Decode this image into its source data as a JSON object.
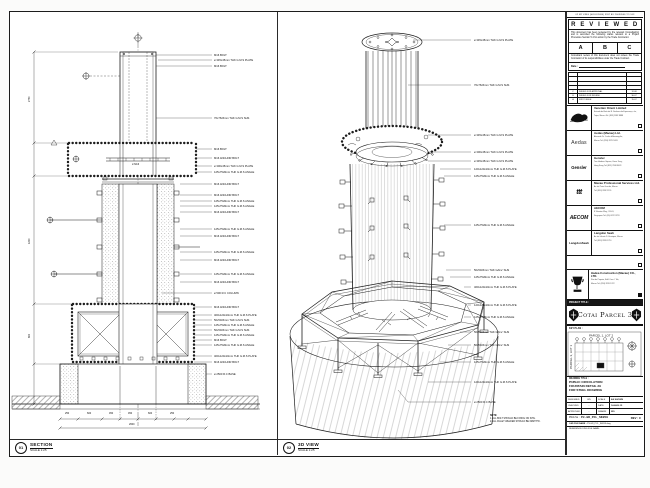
{
  "views": {
    "section": {
      "id": "01",
      "title": "SECTION",
      "scale": "SCALE 1:25",
      "callouts": [
        {
          "y": 43,
          "t": "M16 BOLT"
        },
        {
          "y": 48,
          "t": "ø 345x45mm THK G.M.S PLATE"
        },
        {
          "y": 54,
          "t": "M16 BOLT"
        },
        {
          "y": 106,
          "t": "76x76x5mm THK G.M.S SHS"
        },
        {
          "y": 137,
          "t": "M16 BOLT"
        },
        {
          "y": 146,
          "t": "M16 ANCHOR BOLT"
        },
        {
          "y": 154,
          "t": "ø 300x45mm THK G.M.S PLATE"
        },
        {
          "y": 160,
          "t": "125x75x8mm THK G.M.S ANGLE"
        },
        {
          "y": 172,
          "t": "M16 ANCHOR BOLT"
        },
        {
          "y": 183,
          "t": "M16 ANCHOR BOLT"
        },
        {
          "y": 189,
          "t": "125x75x8mm THK G.M.S ANGLE"
        },
        {
          "y": 194,
          "t": "125x75x8mm THK G.M.S ANGLE"
        },
        {
          "y": 200,
          "t": "M16 ANCHOR BOLT"
        },
        {
          "y": 217,
          "t": "125x75x8mm THK G.M.S ANGLE"
        },
        {
          "y": 224,
          "t": "M16 ANCHOR BOLT"
        },
        {
          "y": 240,
          "t": "125x75x8mm THK G.M.S ANGLE"
        },
        {
          "y": 248,
          "t": "M16 ANCHOR BOLT"
        },
        {
          "y": 262,
          "t": "125x75x8mm THK G.M.S ANGLE"
        },
        {
          "y": 270,
          "t": "M16 ANCHOR BOLT"
        },
        {
          "y": 281,
          "t": "ø 500 R.C COLUMN"
        },
        {
          "y": 295,
          "t": "M16 ANCHOR BOLT"
        },
        {
          "y": 303,
          "t": "400x120x10mm THK G.M.S PLATE"
        },
        {
          "y": 308,
          "t": "50x50x5mm THK G.M.S SHS"
        },
        {
          "y": 313,
          "t": "125x75x8mm THK G.M.S ANGLE"
        },
        {
          "y": 318,
          "t": "50x50x5mm THK G.M.S SHS"
        },
        {
          "y": 323,
          "t": "125x75x8mm THK G.M.S ANGLE"
        },
        {
          "y": 328,
          "t": "M16 BOLT"
        },
        {
          "y": 333,
          "t": "125x75x8mm THK G.M.S ANGLE"
        },
        {
          "y": 344,
          "t": "400x120x10mm THK G.M.S PLATE"
        },
        {
          "y": 350,
          "t": "M16 ANCHOR BOLT"
        },
        {
          "y": 362,
          "t": "ø 2500 R.C BASE"
        }
      ],
      "microtexts": [
        {
          "x": 55,
          "y": 401,
          "t": "250"
        },
        {
          "x": 77,
          "y": 401,
          "t": "600"
        },
        {
          "x": 99,
          "y": 401,
          "t": "450"
        },
        {
          "x": 118,
          "y": 401,
          "t": "450"
        },
        {
          "x": 138,
          "y": 401,
          "t": "600"
        },
        {
          "x": 160,
          "y": 401,
          "t": "250"
        },
        {
          "x": 119,
          "y": 412,
          "t": "2600"
        },
        {
          "x": 19,
          "y": 90,
          "t": "2750",
          "r": -90
        },
        {
          "x": 19,
          "y": 232,
          "t": "1200",
          "r": -90
        },
        {
          "x": 19,
          "y": 326,
          "t": "800",
          "r": -90
        },
        {
          "x": 122,
          "y": 152,
          "t": "2-M16"
        }
      ]
    },
    "iso": {
      "id": "02",
      "title": "3D VIEW",
      "scale": "SCALE 1:25",
      "callouts": [
        {
          "y": 28,
          "t": "ø 345x45mm THK G.M.S PLATE"
        },
        {
          "y": 73,
          "t": "76x76x5mm THK G.M.S SHS"
        },
        {
          "y": 123,
          "t": "ø 345x45mm THK G.M.S PLATE"
        },
        {
          "y": 140,
          "t": "ø 300x45mm THK G.M.S PLATE"
        },
        {
          "y": 149,
          "t": "ø 345x45mm THK G.M.S PLATE"
        },
        {
          "y": 157,
          "t": "120x120x10mm THK G.M.S PLATE"
        },
        {
          "y": 164,
          "t": "125x75x8mm THK G.M.S ANGLE"
        },
        {
          "y": 213,
          "t": "125x75x8mm THK G.M.S ANGLE"
        },
        {
          "y": 258,
          "t": "50x50x5mm THK GALV. SHS"
        },
        {
          "y": 265,
          "t": "125x75x8mm THK G.M.S ANGLE"
        },
        {
          "y": 275,
          "t": "460x120x10mm THK G.M.S PLATE"
        },
        {
          "y": 293,
          "t": "120x120x10mm THK G.M.S PLATE"
        },
        {
          "y": 305,
          "t": "125x75x8mm THK G.M.S ANGLE"
        },
        {
          "y": 320,
          "t": "50x50x5mm THK GALV. SHS"
        },
        {
          "y": 333,
          "t": "50x50x5mm THK GALV. SHS"
        },
        {
          "y": 350,
          "t": "125x75x8mm THK G.M.S ANGLE"
        },
        {
          "y": 370,
          "t": "120x120x10mm THK G.M.S PLATE"
        },
        {
          "y": 390,
          "t": "ø 2500 R.C BASE"
        }
      ],
      "note_title": "NOTE:",
      "note1": "1. ALL BOLT SHOULD BE FIXING ON SITE.",
      "note2": "2. ALL FILLET WELDED SHOULD BE 6MM THK."
    }
  },
  "titleblock": {
    "fax_header": "02 MY KING (HOLDINGS) 9997 AY 20030506 TO 103",
    "stamp": {
      "title": "R E V I E W E D",
      "para1": "This document has been reviewed by the relevant Consultant(s) and is accorded the following status relevant to a Project Procedure Section 5.4 for action by the Trade Contractor.",
      "options": {
        "a": "A",
        "b": "B",
        "c": "C"
      },
      "para2": "Consultant review of this document does not relieve the Trade Contractor of its responsibilities under the Trade Contract.",
      "date_label": "Date :"
    },
    "revisions": [
      {
        "rev": "",
        "desc": "",
        "date": ""
      },
      {
        "rev": "",
        "desc": "",
        "date": ""
      },
      {
        "rev": "",
        "desc": "",
        "date": ""
      },
      {
        "rev": "",
        "desc": "",
        "date": ""
      },
      {
        "rev": "C",
        "desc": "ISSUED FOR APPROVAL",
        "date": "12-08"
      },
      {
        "rev": "B",
        "desc": "ISSUED FOR REVIEW",
        "date": "30-07"
      },
      {
        "rev": "A",
        "desc": "FIRST ISSUE",
        "date": "15-07"
      }
    ],
    "consultants": [
      {
        "logo": "VOL",
        "name": "Venetian Orient Limited",
        "line1": "Estrada da Baía de N. Senhora da Esperança, s/n,",
        "line2": "Taipa, Macau   Tel: (853) 2882 8888"
      },
      {
        "logo": "Aedas",
        "name": "Aedas (Macau) Ltd.",
        "line1": "Alameda Dr. Carlos d'Assumpção,",
        "line2": "Macau   Tel: (853) 2875 5033"
      },
      {
        "logo": "Gensler",
        "name": "Gensler",
        "line1": "Two Harbour Square, Kwun Tong,",
        "line2": "Hong Kong   Tel: (852) 2598 8023"
      },
      {
        "logo": "ttt",
        "name": "Macau Professional Services Ltd.",
        "line1": "Av. da Praia Grande, Macau",
        "line2": "Tel: (853) 2832 2155"
      },
      {
        "logo": "AECOM",
        "name": "AECOM",
        "line1": "8 Shenton Way, #11-01,",
        "line2": "Singapore   Tel: (65) 6222 3733"
      },
      {
        "logo": "LangdonSeah",
        "name": "Langdon Seah",
        "line1": "Av. do Infante D. Henrique, Macau",
        "line2": "Tel: (853) 2833 1710"
      }
    ],
    "contractor": {
      "name": "Hadea Construction (Macau) CO., LTD.",
      "line1": "Rua de Pequim, Edif. Com. I Tak,",
      "line2": "Macau   Tel: (853) 2870 1222"
    },
    "project_title_label": "PROJECT TITLE :",
    "project_title": "Cotai Parcel 3",
    "key_plan_label": "KEY PLAN :",
    "key_plan": {
      "top_label": "PARCEL 1, LOT 2",
      "side_label": "PARCEL 3, LOT 1"
    },
    "drawing_title_label": "DRAWING TITLE :",
    "drawing_title": {
      "l1": "PUBLIC CIRCULATION",
      "l2": "FOUNTAIN DETAIL 29",
      "l3": "FOR STEEL DRAWING"
    },
    "approvals": [
      {
        "label": "DESIGNED",
        "value": "WS",
        "label2": "SCALE",
        "value2": "AS SHOWN"
      },
      {
        "label": "CHECKED",
        "value": "-",
        "label2": "DATE",
        "value2": "14-AUG-15"
      },
      {
        "label": "APPROVED",
        "value": "-",
        "label2": "DRAWN",
        "value2": "WS"
      }
    ],
    "dwg_no_label": "DWG No :",
    "dwg_no": "P3-GR_PCL_SK059",
    "rev_text": "REV : C",
    "cad_label": "CAD FILE NAME :",
    "cad_value": "P3-GR_PCL_SK059.dwg",
    "ref_label": "REFERENCE DWG FILE NAME :"
  }
}
